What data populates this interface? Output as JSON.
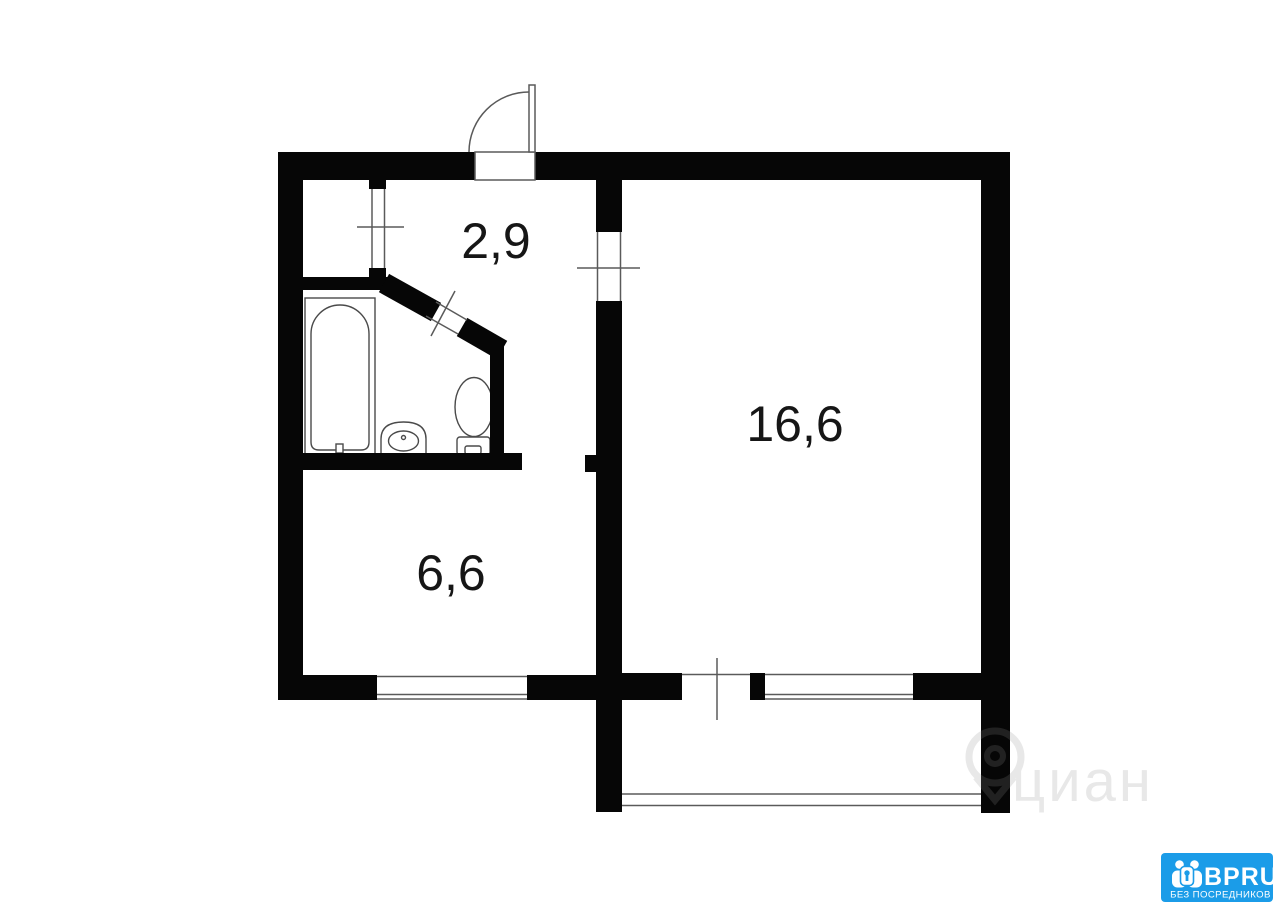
{
  "plan": {
    "type": "apartment-floorplan",
    "rooms": [
      {
        "name": "hallway",
        "area_label": "2,9"
      },
      {
        "name": "living-room",
        "area_label": "16,6"
      },
      {
        "name": "kitchen",
        "area_label": "6,6"
      }
    ],
    "features": [
      "entrance-door",
      "storage-closet",
      "bathroom",
      "bathtub",
      "sink",
      "toilet",
      "windows",
      "balcony"
    ],
    "colors": {
      "wall": "#060606",
      "background": "#ffffff",
      "thin_line": "#5a5a5a"
    }
  },
  "watermark": {
    "text": "циан",
    "icon": "map-pin-icon",
    "color": "#8f8f8f"
  },
  "logo": {
    "brand": "BPRU",
    "tagline": "БЕЗ ПОСРЕДНИКОВ",
    "background": "#1b9ce8",
    "text_color": "#ffffff",
    "icon": "people-key-icon"
  }
}
